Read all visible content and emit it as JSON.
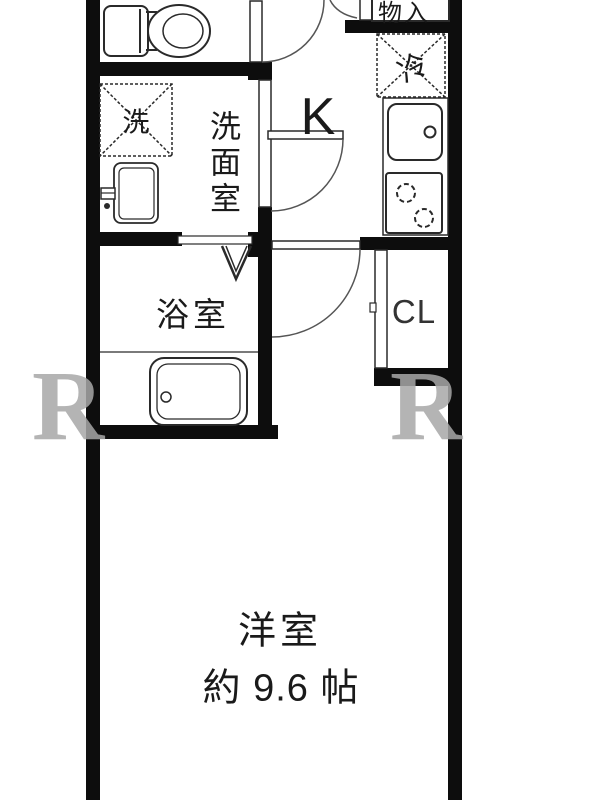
{
  "labels": {
    "storage": "物入",
    "fridge": "冷",
    "kitchen": "K",
    "washer": "洗",
    "washroom": "洗面室",
    "bath": "浴室",
    "closet": "CL",
    "room_name": "洋室",
    "room_size": "約 9.6 帖"
  },
  "watermark": {
    "left": "R",
    "right": "R"
  },
  "colors": {
    "wall": "#0d0d0d",
    "line": "#2a2a2a",
    "text": "#1a1a1a",
    "watermark": "#a8a8a8"
  }
}
